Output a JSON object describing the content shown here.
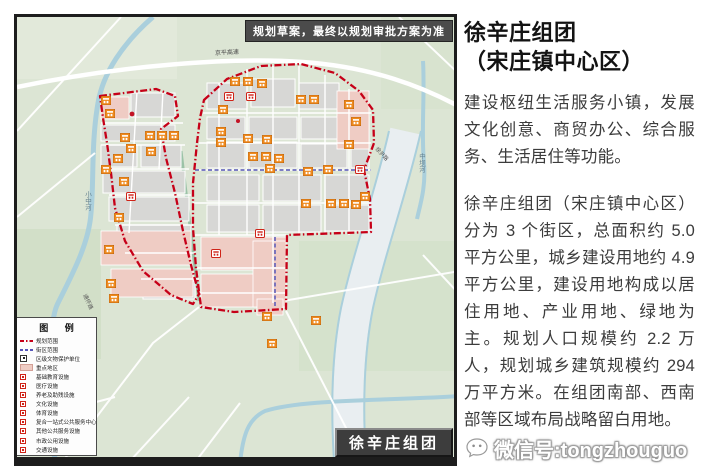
{
  "map": {
    "disclaimer": "规划草案，最终以规划审批方案为准",
    "area_banner": "徐辛庄组团",
    "labels": {
      "expressway": "京平高速",
      "river_left": "小中河",
      "river_mid": "中坝河",
      "road_right": "徐尹路",
      "road_sw": "通怀路"
    },
    "legend": {
      "title": "图 例",
      "items": [
        {
          "label": "规划范围"
        },
        {
          "label": "街区范围"
        },
        {
          "label": "区级文物保护单位"
        },
        {
          "label": "重点地区"
        },
        {
          "label": "基础教育设施"
        },
        {
          "label": "医疗设施"
        },
        {
          "label": "养老及助残设施"
        },
        {
          "label": "文化设施"
        },
        {
          "label": "体育设施"
        },
        {
          "label": "复合一站式公共服务中心"
        },
        {
          "label": "其他公共服务设施"
        },
        {
          "label": "市政公用设施"
        },
        {
          "label": "交通设施"
        }
      ]
    }
  },
  "panel": {
    "title_line1": "徐辛庄组团",
    "title_line2": "（宋庄镇中心区）",
    "paragraph1": "建设枢纽生活服务小镇，发展文化创意、商贸办公、综合服务、生活居住等功能。",
    "paragraph2": "徐辛庄组团（宋庄镇中心区）分为 3 个街区，总面积约 5.0 平方公里，城乡建设用地约 4.9 平方公里，建设用地构成以居住用地、产业用地、绿地为主。规划人口规模约 2.2 万人，规划城乡建筑规模约 294 万平方米。在组团南部、西南部等区域布局战略留白用地。"
  },
  "watermark": {
    "text": "微信号:tongzhouguo"
  },
  "colors": {
    "boundary_red": "#c60018",
    "block_boundary_blue": "#5656b8",
    "facility_orange": "#ee8a1f",
    "key_area_pink": "#efccc4",
    "river_blue": "#aacfdc"
  }
}
